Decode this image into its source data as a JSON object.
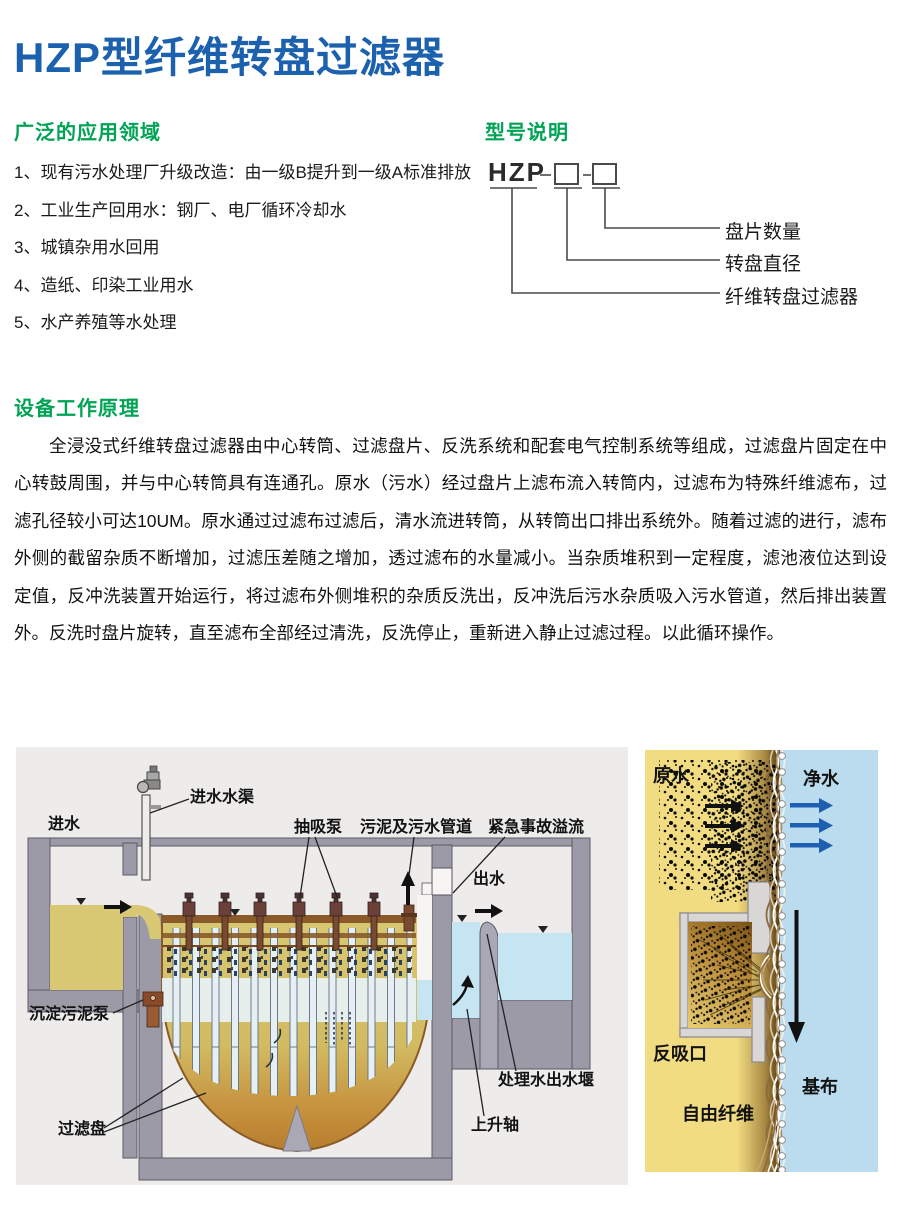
{
  "page": {
    "title": "HZP型纤维转盘过滤器"
  },
  "colors": {
    "title_blue": "#1B61AE",
    "heading_green": "#00A355",
    "raw_water_yellow": "#D9C873",
    "clean_water_blue": "#C5E5F2",
    "wall_gray": "#9D9AA8",
    "flow_arrow_blue": "#1D5FB0"
  },
  "applications": {
    "heading": "广泛的应用领域",
    "items": [
      "1、现有污水处理厂升级改造：由一级B提升到一级A标准排放",
      "2、工业生产回用水：钢厂、电厂循环冷却水",
      "3、城镇杂用水回用",
      "4、造纸、印染工业用水",
      "5、水产养殖等水处理"
    ]
  },
  "model": {
    "heading": "型号说明",
    "code": "HZP",
    "labels": {
      "disc_count": "盘片数量",
      "disc_diameter": "转盘直径",
      "product": "纤维转盘过滤器"
    }
  },
  "principle": {
    "heading": "设备工作原理",
    "text": "全浸没式纤维转盘过滤器由中心转筒、过滤盘片、反洗系统和配套电气控制系统等组成，过滤盘片固定在中心转鼓周围，并与中心转筒具有连通孔。原水（污水）经过盘片上滤布流入转筒内，过滤布为特殊纤维滤布，过滤孔径较小可达10UM。原水通过过滤布过滤后，清水流进转筒，从转筒出口排出系统外。随着过滤的进行，滤布外侧的截留杂质不断增加，过滤压差随之增加，透过滤布的水量减小。当杂质堆积到一定程度，滤池液位达到设定值，反冲洗装置开始运行，将过滤布外侧堆积的杂质反洗出，反冲洗后污水杂质吸入污水管道，然后排出装置外。反洗时盘片旋转，直至滤布全部经过清洗，反洗停止，重新进入静止过滤过程。以此循环操作。"
  },
  "tank_diagram": {
    "labels": {
      "inlet": "进水",
      "inlet_channel": "进水水渠",
      "suction_pump": "抽吸泵",
      "sludge_pipe": "污泥及污水管道",
      "emergency_overflow": "紧急事故溢流",
      "outlet": "出水",
      "sediment_pump": "沉淀污泥泵",
      "filter_disc": "过滤盘",
      "outlet_weir": "处理水出水堰",
      "rising_shaft": "上升轴"
    }
  },
  "membrane_diagram": {
    "labels": {
      "raw_water": "原水",
      "clean_water": "净水",
      "back_suction_port": "反吸口",
      "base_cloth": "基布",
      "free_fiber": "自由纤维"
    }
  }
}
